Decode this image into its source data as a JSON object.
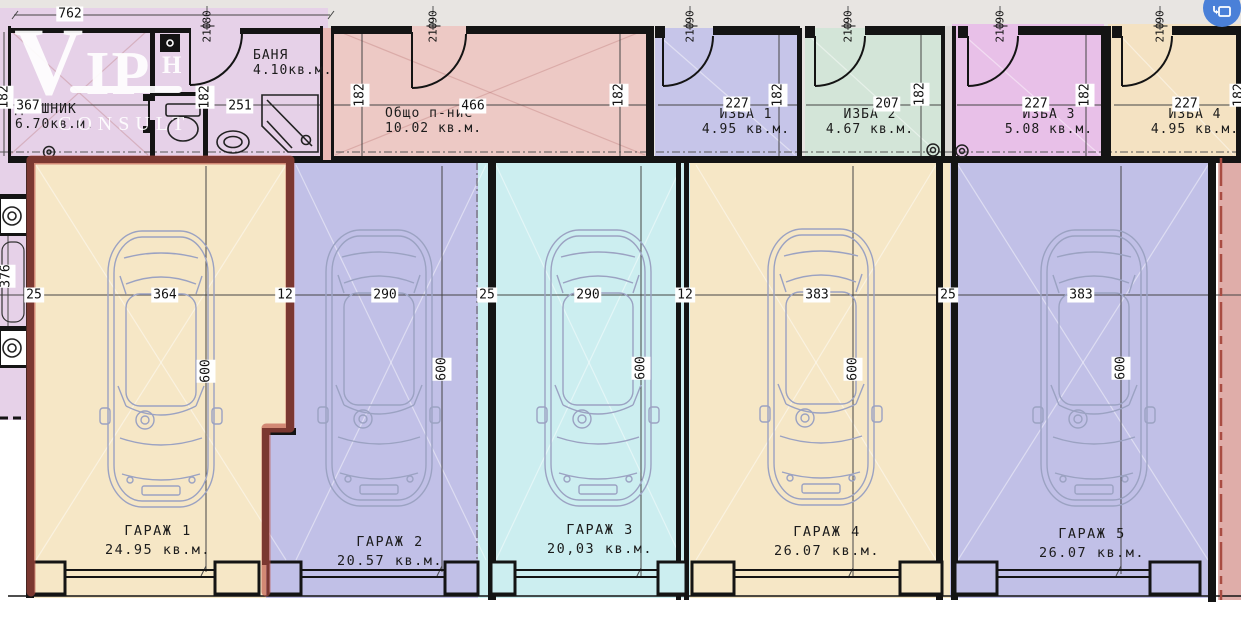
{
  "watermark": {
    "line1": "VIP",
    "mark": "Н",
    "line2": "CONSULT"
  },
  "browser_icon": {
    "name": "image-translate"
  },
  "dims": {
    "top_width": "762",
    "left_strip_width": "376",
    "cellar_depth": "182",
    "garage_line": [
      "25",
      "364",
      "12",
      "290",
      "25",
      "290",
      "12",
      "383",
      "25",
      "383"
    ]
  },
  "rooms": {
    "dreshnik": {
      "name": "ДРЕШНИК",
      "area": "6.70кв.м.",
      "width": "367"
    },
    "banya": {
      "name": "БАНЯ",
      "area": "4.10кв.м.",
      "width": "251",
      "door_w": "80",
      "door_h": "210"
    },
    "common": {
      "name": "Общо п-ние",
      "area": "10.02 кв.м.",
      "width": "466",
      "door_w": "90",
      "door_h": "210"
    },
    "izba1": {
      "name": "ИЗБА 1",
      "area": "4.95 кв.м.",
      "width": "227",
      "door_w": "90",
      "door_h": "210"
    },
    "izba2": {
      "name": "ИЗБА 2",
      "area": "4.67 кв.м.",
      "width": "207",
      "door_w": "90",
      "door_h": "210"
    },
    "izba3": {
      "name": "ИЗБА 3",
      "area": "5.08 кв.м.",
      "width": "227",
      "door_w": "90",
      "door_h": "210"
    },
    "izba4": {
      "name": "ИЗБА 4",
      "area": "4.95 кв.м.",
      "width": "227",
      "door_w": "90",
      "door_h": "210"
    }
  },
  "garages": [
    {
      "name": "ГАРАЖ 1",
      "area": "24.95 кв.м.",
      "width": "364",
      "depth": "600",
      "highlighted": true
    },
    {
      "name": "ГАРАЖ 2",
      "area": "20.57 кв.м.",
      "width": "290",
      "depth": "600",
      "highlighted": false
    },
    {
      "name": "ГАРАЖ 3",
      "area": "20,03 кв.м.",
      "width": "290",
      "depth": "600",
      "highlighted": false
    },
    {
      "name": "ГАРАЖ 4",
      "area": "26.07 кв.м.",
      "width": "383",
      "depth": "600",
      "highlighted": false
    },
    {
      "name": "ГАРАЖ 5",
      "area": "26.07 кв.м.",
      "width": "383",
      "depth": "600",
      "highlighted": false
    }
  ],
  "colors": {
    "lavender": "#e6d1e8",
    "salmon": "#edc9c5",
    "izba_blue": "#c6c5e9",
    "izba_green": "#d3e5d8",
    "izba_magenta": "#e8c0e8",
    "izba_beige": "#f4e2c2",
    "garage_beige": "#f6e7c6",
    "garage_blue": "#c1c0e7",
    "garage_cyan": "#cceef0",
    "strip_salmon": "#dfada9",
    "highlight_red": "#bb4f44",
    "wall": "#141414"
  }
}
